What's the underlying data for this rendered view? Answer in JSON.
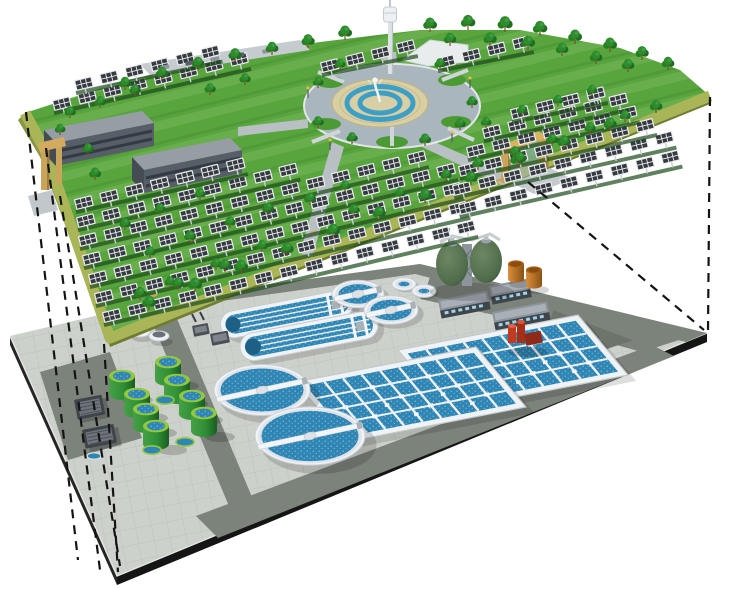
{
  "scene": {
    "type": "3d-cutaway-architectural-rendering",
    "description": "Concept illustration of an underground wastewater treatment plant located beneath a ground-level solar photovoltaic park; the two levels are linked by dashed projection lines showing the buried plant footprint",
    "background_color": "#ffffff",
    "upper_level": {
      "label": "solar park deck",
      "features": [
        "solar panel rows",
        "tree rows",
        "lawn",
        "office buildings",
        "circular fountain plaza",
        "observation tower",
        "entrance gates",
        "olive perimeter band",
        "gray footpaths",
        "benches"
      ],
      "solar_panel_row_count": 15,
      "building_count": 2,
      "gate_count": 2,
      "tower_count": 1,
      "fountain": {
        "rings": [
          "outer paved ring",
          "tan pavement",
          "blue water rings",
          "central jet"
        ]
      }
    },
    "lower_level": {
      "label": "underground wastewater treatment plant",
      "features": [
        "tiled concrete platform",
        "service roads",
        "oxidation ditches",
        "circular clarifiers",
        "aeration basins",
        "sludge storage tanks",
        "egg-shaped digesters",
        "oil tanks",
        "pump station",
        "equipment skids",
        "silos"
      ],
      "oxidation_ditch_count": 2,
      "large_clarifier_count": 2,
      "small_clarifier_count": 4,
      "aeration_basin_count": 2,
      "green_tank_count": 8,
      "digester_count": 2,
      "orange_tank_count": 2,
      "service_building_count": 3
    },
    "projection_lines": {
      "style": "dashed",
      "left_line_count": 4,
      "right_line_count": 2
    },
    "palette": {
      "bg": "#ffffff",
      "grass": "#58a53d",
      "band": "#a9b556",
      "bandFace": "#76843a",
      "tree": "#1f6d22",
      "treeLight": "#2e8b2e",
      "panelDark": "#363b41",
      "panelFrame": "#eceef0",
      "buildingFace": "#565e67",
      "buildingRoof": "#969da4",
      "plazaRing": "#aab6bd",
      "plazaPave": "#d8cfa4",
      "plazaBlue": "#3e9fc6",
      "towerWhite": "#eef1f3",
      "platform": "#cdd1cb",
      "road": "#7c837b",
      "edgeBlack": "#151515",
      "tankWhite": "#f0f3f5",
      "water": "#2f86b4",
      "greenTank": "#2f8f35",
      "greenTankRim": "#93c83e",
      "digester": "#4f6c4a",
      "orange": "#c07830",
      "red": "#c23b20",
      "gateTan": "#c9a55b",
      "dash": "#141414"
    }
  }
}
